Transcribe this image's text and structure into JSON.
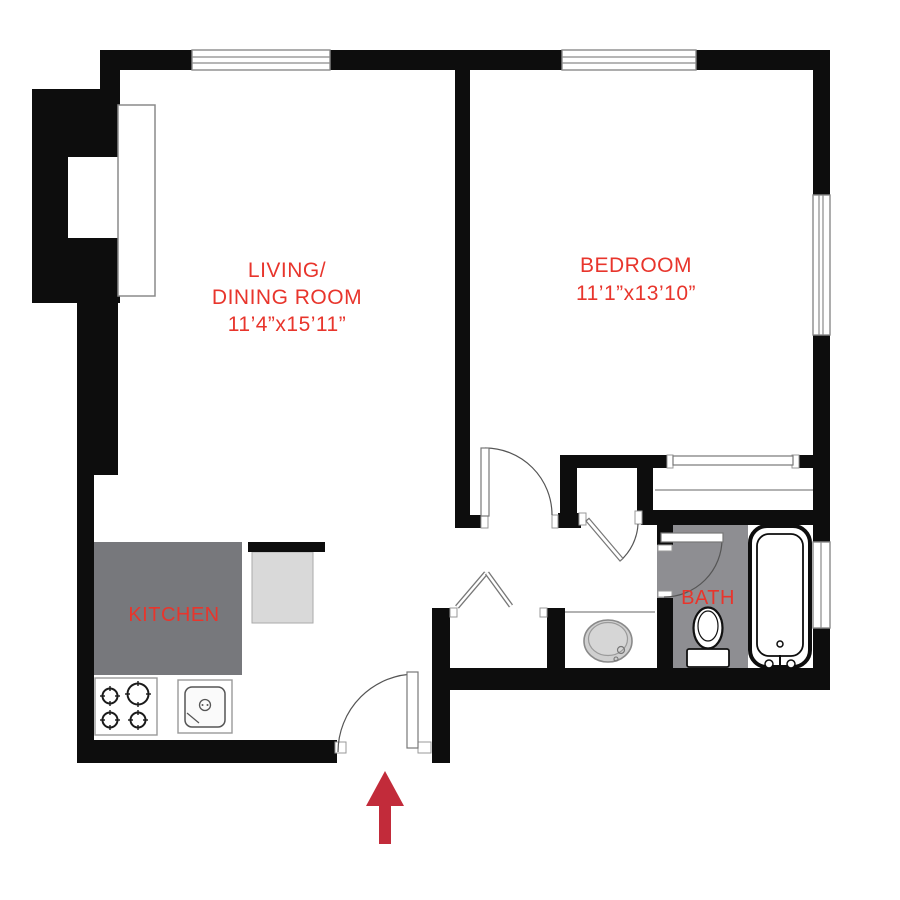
{
  "title": "One-bedroom apartment floor plan",
  "labels": {
    "living_line1": "LIVING/",
    "living_line2": "DINING ROOM",
    "living_dims": "11’4”x15’11”",
    "bedroom": "BEDROOM",
    "bedroom_dims": "11’1”x13’10”",
    "kitchen": "KITCHEN",
    "bath": "BATH"
  },
  "rooms": [
    {
      "name": "Living/Dining Room",
      "dimensions": "11'4\" x 15'11\""
    },
    {
      "name": "Bedroom",
      "dimensions": "11'1\" x 13'10\""
    },
    {
      "name": "Kitchen"
    },
    {
      "name": "Bath"
    }
  ],
  "fixtures": {
    "stove": "stove-4-burner",
    "kitchen_sink": "kitchen-sink",
    "vanity_sink": "vanity-sink",
    "toilet": "toilet",
    "bathtub": "bathtub",
    "entry_arrow": "entrance-arrow",
    "windows": 4,
    "doors": [
      "entry-swing-door",
      "bedroom-swing-door",
      "hall-swing-door",
      "bath-swing-door",
      "closet-bifold-door",
      "closet-sliding-door"
    ]
  },
  "colors": {
    "label_red": "#e8352c",
    "arrow_red": "#c22b3a",
    "wall_black": "#0d0d0d",
    "kitchen_floor": "#77787c",
    "bath_floor": "#8e8e92",
    "counter_gray": "#d9d9d9",
    "sink_gray": "#cfcfcf"
  }
}
